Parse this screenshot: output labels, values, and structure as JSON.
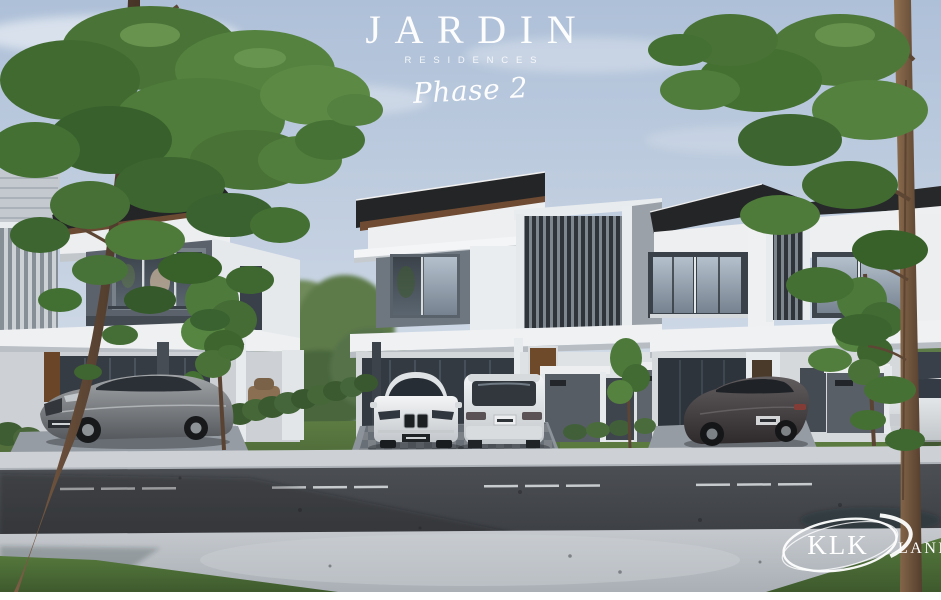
{
  "branding": {
    "title": "JARDIN",
    "subtitle": "RESIDENCES",
    "phase": "Phase 2",
    "developer_name": "KLK",
    "developer_word": "LAND"
  },
  "scene": {
    "palette": {
      "sky_top": "#aec0d8",
      "sky_horizon": "#e6ebf1",
      "foliage_green": "#4a7437",
      "lawn_green": "#5b7a40",
      "roof_dark": "#232526",
      "roof_wood": "#6e4b32",
      "wall_white": "#edeff1",
      "facade_grey": "#5b626b",
      "window_frame": "#2c3238",
      "door_wood": "#6f4a2a",
      "road_asphalt": "#43464b",
      "sidewalk_grey": "#c2c6cb",
      "logo_text": "#ffffff"
    }
  }
}
